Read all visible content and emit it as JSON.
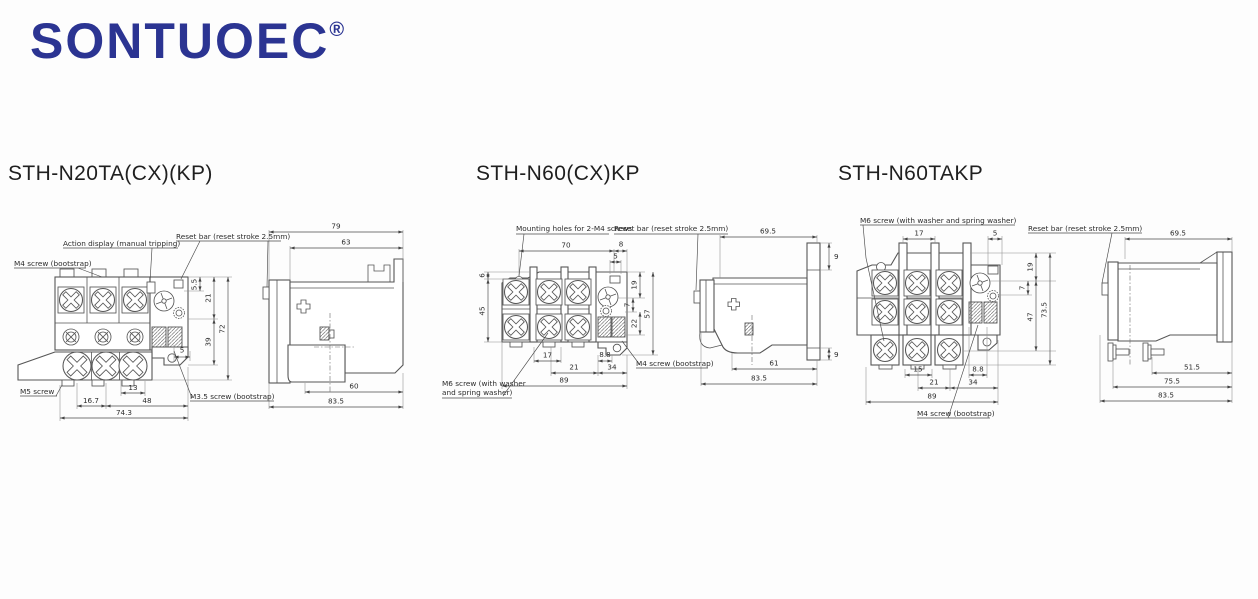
{
  "brand": {
    "name": "SONTUOEC",
    "mark": "®",
    "color": "#2b3492"
  },
  "drawings": [
    {
      "title": "STH-N20TA(CX)(KP)",
      "callouts": {
        "m4_screw": "M4 screw (bootstrap)",
        "action_display": "Action display (manual tripping)",
        "reset_bar": "Reset bar (reset stroke 2.5mm)",
        "m5_screw": "M5 screw",
        "m3_5_screw": "M3.5 screw (bootstrap)"
      },
      "front_dims": {
        "offset_5_5": "5.5",
        "height_21": "21",
        "height_39": "39",
        "height_72": "72",
        "offset_5": "5",
        "width_13": "13",
        "width_16_7": "16.7",
        "width_48": "48",
        "width_74_3": "74.3"
      },
      "side_dims": {
        "depth_79": "79",
        "depth_63": "63",
        "depth_60": "60",
        "depth_83_5": "83.5"
      }
    },
    {
      "title": "STH-N60(CX)KP",
      "callouts": {
        "mounting_holes": "Mounting holes for 2-M4 screws",
        "reset_bar": "Reset bar (reset stroke 2.5mm)",
        "m6_screw_line1": "M6 screw (with washer",
        "m6_screw_line2": "and spring washer)",
        "m4_screw": "M4 screw (bootstrap)"
      },
      "front_dims": {
        "width_70": "70",
        "width_8": "8",
        "width_5": "5",
        "height_6": "6",
        "height_45": "45",
        "height_19": "19",
        "height_7": "7",
        "height_22": "22",
        "height_57": "57",
        "width_17": "17",
        "width_8_8": "8.8",
        "width_21": "21",
        "width_34": "34",
        "width_89": "89"
      },
      "side_dims": {
        "depth_69_5": "69.5",
        "height_9_top": "9",
        "height_9_bottom": "9",
        "depth_61": "61",
        "depth_83_5": "83.5"
      }
    },
    {
      "title": "STH-N60TAKP",
      "callouts": {
        "m6_screw": "M6 screw (with washer and spring washer)",
        "reset_bar": "Reset bar (reset stroke 2.5mm)",
        "m4_screw": "M4 screw (bootstrap)"
      },
      "front_dims": {
        "width_17": "17",
        "width_5": "5",
        "height_19": "19",
        "height_7": "7",
        "height_47": "47",
        "height_73_5": "73.5",
        "width_15": "15",
        "width_8_8": "8.8",
        "width_21": "21",
        "width_34": "34",
        "width_89": "89"
      },
      "side_dims": {
        "depth_69_5": "69.5",
        "depth_51_5": "51.5",
        "depth_75_5": "75.5",
        "depth_83_5": "83.5"
      }
    }
  ]
}
